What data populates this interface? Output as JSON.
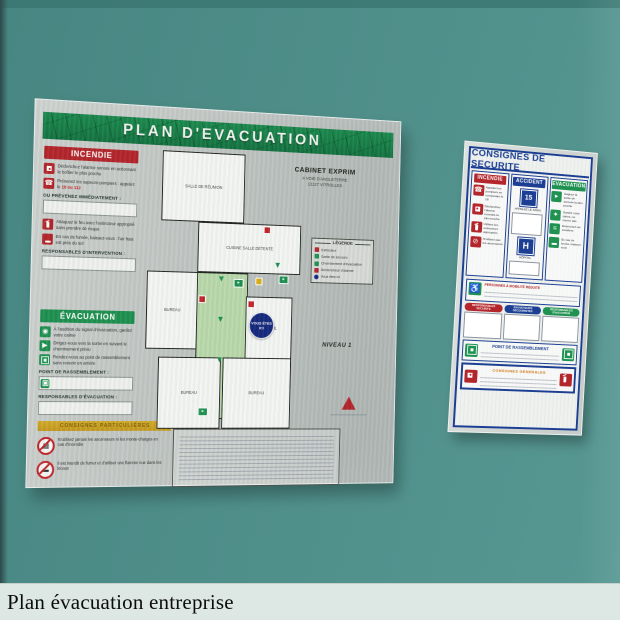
{
  "caption": "Plan évacuation entreprise",
  "left_sign": {
    "title": "PLAN  D'EVACUATION",
    "incendie": {
      "title": "INCENDIE",
      "items": [
        "Déclenchez l'alarme sonore en actionnant le boîtier le plus proche",
        "Prévenez les sapeurs-pompiers : appelez le ",
        "Attaquez le feu avec l'extincteur approprié sans prendre de risque",
        "En cas de fumée, baissez-vous : l'air frais est près du sol"
      ],
      "phone_numbers": "18 ou 112",
      "prevenez_label": "OU PRÉVENEZ IMMÉDIATEMENT :",
      "responsables_label": "RESPONSABLES D'INTERVENTION :"
    },
    "evacuation": {
      "title": "ÉVACUATION",
      "items": [
        "À l'audition du signal d'évacuation, gardez votre calme",
        "Dirigez-vous vers la sortie en suivant le cheminement prévu",
        "Rendez-vous au point de rassemblement sans revenir en arrière"
      ],
      "point_label": "POINT DE RASSEMBLEMENT :",
      "responsables_label": "RESPONSABLES D'ÉVACUATION :"
    },
    "particulieres_banner": "CONSIGNES PARTICULIÈRES",
    "interdictions": [
      "N'utilisez jamais les ascenseurs ni les monte-charges en cas d'incendie",
      "Il est interdit de fumer et d'utiliser une flamme nue dans les locaux"
    ],
    "site": {
      "name": "CABINET EXPRIM",
      "address_line1": "4 VOIE D'ANGLETERRE",
      "address_line2": "13127 VITROLLES"
    },
    "legend": {
      "title": "LÉGENDE",
      "items": [
        {
          "label": "Extincteur",
          "color": "#b3262b"
        },
        {
          "label": "Sortie de secours",
          "color": "#1f9150"
        },
        {
          "label": "Cheminement d'évacuation",
          "color": "#1f9150"
        },
        {
          "label": "Déclencheur d'alarme",
          "color": "#b3262b"
        },
        {
          "label": "Vous êtes ici",
          "color": "#16297d"
        }
      ]
    },
    "niveau": "NIVEAU 1",
    "you_are_here": "VOUS ÊTES ICI",
    "rooms": {
      "salle_reunion": "SALLE DE RÉUNION",
      "cuisine": "CUISINE SALLE DÉTENTE",
      "bureau1": "BUREAU",
      "accueil": "ACCUEIL",
      "bureau2": "BUREAU",
      "bureau3": "BUREAU"
    }
  },
  "right_sign": {
    "title": "CONSIGNES DE SECURITE",
    "incendie": {
      "title": "INCENDIE",
      "items": [
        "Appelez les pompiers en composant le 18",
        "Déclenchez l'alarme incendie la plus proche",
        "Utilisez les extincteurs appropriés",
        "N'utilisez pas les ascenseurs"
      ]
    },
    "accident": {
      "title": "ACCIDENT",
      "samu_number": "15",
      "samu_label": "APPELEZ LE SAMU",
      "hospital_letter": "H",
      "hospital_label": "HÔPITAL"
    },
    "evacuation": {
      "title": "EVACUATION",
      "items": [
        "Gagnez la sortie de secours la plus proche",
        "Gardez votre calme, ne courez pas",
        "Empruntez les escaliers",
        "En cas de fumée, baissez-vous"
      ]
    },
    "pmr_title": "PERSONNES À MOBILITÉ RÉDUITE",
    "pills": [
      "RESPONSABLES SECURITE",
      "SAUVETEURS SECOURISTES",
      "RESPONSABLES EVACUATION"
    ],
    "point_label": "POINT DE RASSEMBLEMENT",
    "generales_title": "CONSIGNES GENERALES"
  },
  "colors": {
    "wall": "#50908b",
    "header_green": "#17834a",
    "red": "#b3262b",
    "blue": "#1d3f93",
    "green": "#1f9150"
  }
}
